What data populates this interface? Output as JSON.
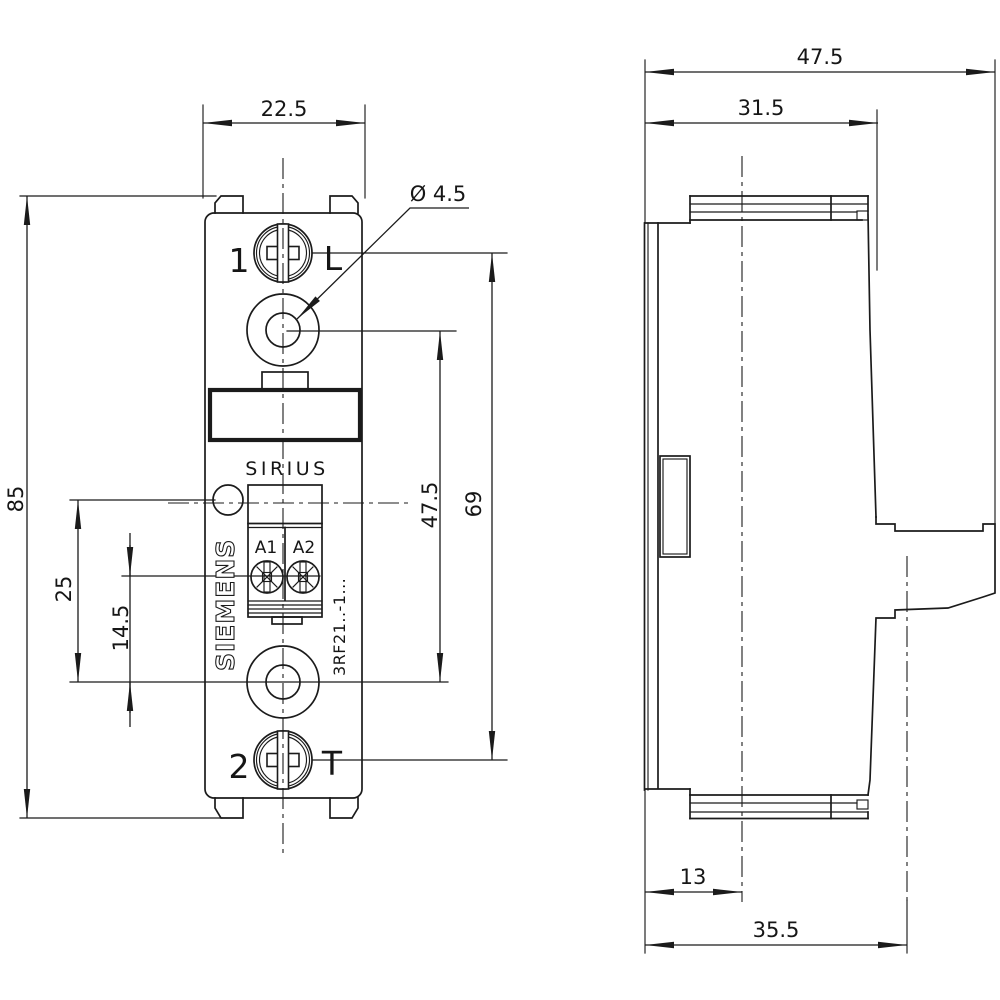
{
  "drawing": {
    "type": "technical-dimension-drawing",
    "front": {
      "brand": "SIEMENS",
      "series": "SIRIUS",
      "model": "3RF21..-1...",
      "terminal_a1": "A1",
      "terminal_a2": "A2",
      "screw_top_number": "1",
      "screw_top_letter": "L",
      "screw_bottom_number": "2",
      "screw_bottom_letter": "T",
      "dim_width": "22.5",
      "dim_height": "85",
      "dim_led_offset": "25",
      "dim_terminal_offset": "14.5",
      "dim_hole_spacing": "47.5",
      "dim_screw_spacing": "69",
      "dim_hole_diameter": "Ø 4.5"
    },
    "side": {
      "dim_depth_total": "47.5",
      "dim_depth_body": "31.5",
      "dim_rail_center": "13",
      "dim_depth_base": "35.5"
    },
    "colors": {
      "line": "#1b1b1b",
      "background": "#ffffff"
    }
  }
}
